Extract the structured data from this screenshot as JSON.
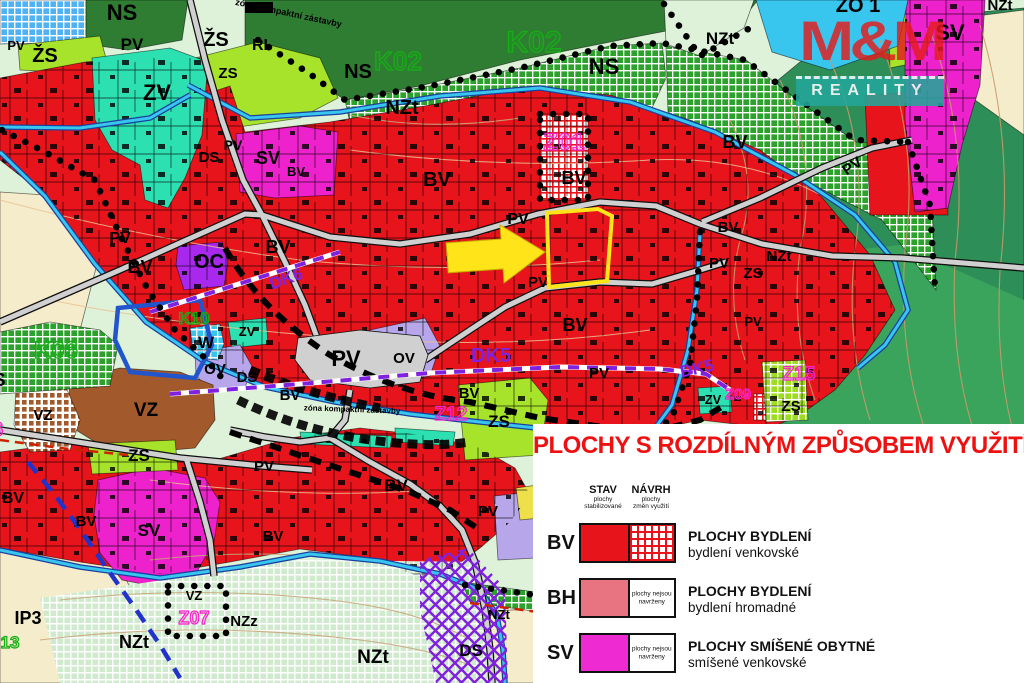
{
  "colors": {
    "bv_red": "#e8141b",
    "zv_teal": "#2de0b2",
    "zs_lime": "#a6e32a",
    "sv_magenta": "#ee22cc",
    "oc_purple": "#a928ee",
    "ov_lavender": "#b7a6ea",
    "vz_brown": "#a2592b",
    "nzt_pale": "#ddf2d8",
    "cream": "#f5eccb",
    "hill_green": "#2e8e57",
    "hill_green2": "#3aa45d",
    "ns_green": "#2f7d32",
    "k_grid_green": "#2ca12c",
    "water_cyan": "#38c6ef",
    "stream_blue": "#1b3f9e",
    "road_gray": "#d0d0d0",
    "blue_grid": "#4fb2f4",
    "pale_grid": "#cfeacc",
    "lime_grid": "#9ddc20",
    "route_purple": "#8021e0",
    "ip_blue": "#2233cc",
    "dash_red": "#cc2200",
    "highlight_yellow": "#ffe41a",
    "label_green": "#15b015",
    "label_magenta": "#f822cc",
    "legend_title_red": "#ee1111",
    "bh_pink": "#e87482",
    "sv_pink": "#ee2ad2",
    "logo_red": "#e41b1b",
    "logo_teal": "#23a79b"
  },
  "map": {
    "labels": [
      [
        "NS",
        122,
        20,
        22,
        "b"
      ],
      [
        "ŽS",
        45,
        62,
        20,
        "b"
      ],
      [
        "PV",
        16,
        50,
        13,
        "b"
      ],
      [
        "ZV",
        157,
        100,
        22,
        "b"
      ],
      [
        "ŽS",
        216,
        46,
        20,
        "b"
      ],
      [
        "ZS",
        228,
        78,
        15,
        "b"
      ],
      [
        "RI",
        260,
        50,
        16,
        "b"
      ],
      [
        "zóna kompaktní zástavby",
        288,
        16,
        9,
        "b",
        12
      ],
      [
        "PV",
        132,
        50,
        17,
        "b"
      ],
      [
        "NS",
        358,
        78,
        20,
        "b"
      ],
      [
        "K02",
        398,
        70,
        26,
        "g"
      ],
      [
        "K02",
        534,
        52,
        30,
        "g"
      ],
      [
        "NS",
        604,
        74,
        22,
        "b"
      ],
      [
        "NZt",
        402,
        114,
        20,
        "b"
      ],
      [
        "NZt",
        720,
        44,
        17,
        "b"
      ],
      [
        "ZO 1",
        858,
        12,
        20,
        "b"
      ],
      [
        "NZt",
        1000,
        10,
        15,
        "b"
      ],
      [
        "SV",
        950,
        40,
        22,
        "b"
      ],
      [
        "Z01",
        564,
        150,
        24,
        "m"
      ],
      [
        "BV",
        437,
        186,
        20,
        "b"
      ],
      [
        "BV",
        574,
        184,
        18,
        "b"
      ],
      [
        "BV",
        735,
        148,
        18,
        "b"
      ],
      [
        "PV",
        233,
        150,
        14,
        "b"
      ],
      [
        "DS",
        209,
        162,
        15,
        "b"
      ],
      [
        "SV",
        268,
        164,
        18,
        "b"
      ],
      [
        "BV",
        296,
        176,
        13,
        "b"
      ],
      [
        "PV",
        518,
        224,
        16,
        "b"
      ],
      [
        "PV",
        855,
        170,
        15,
        "b",
        -35
      ],
      [
        "BV",
        728,
        232,
        15,
        "b"
      ],
      [
        "PV",
        120,
        243,
        16,
        "b"
      ],
      [
        "BV",
        140,
        273,
        18,
        "b"
      ],
      [
        "BV",
        278,
        253,
        18,
        "b"
      ],
      [
        "OC",
        209,
        268,
        20,
        "b"
      ],
      [
        "DK6",
        288,
        284,
        17,
        "p",
        -20
      ],
      [
        "K10",
        194,
        324,
        17,
        "g"
      ],
      [
        "W",
        206,
        348,
        17,
        "b"
      ],
      [
        "ZV",
        247,
        336,
        13,
        "b"
      ],
      [
        "OV",
        215,
        374,
        15,
        "b"
      ],
      [
        "DS",
        247,
        382,
        15,
        "b"
      ],
      [
        "K06",
        56,
        358,
        24,
        "g"
      ],
      [
        "NS",
        -7,
        386,
        18,
        "b"
      ],
      [
        "Z06",
        -14,
        436,
        20,
        "m"
      ],
      [
        "VZ",
        43,
        420,
        15,
        "b"
      ],
      [
        "VZ",
        146,
        416,
        19,
        "b"
      ],
      [
        "PV",
        346,
        366,
        22,
        "b"
      ],
      [
        "OV",
        404,
        363,
        15,
        "b"
      ],
      [
        "zóna kompaktní zástavby",
        352,
        412,
        8,
        "b",
        2
      ],
      [
        "BV",
        290,
        400,
        15,
        "b"
      ],
      [
        "BV",
        469,
        398,
        15,
        "b"
      ],
      [
        "BV",
        575,
        331,
        18,
        "b"
      ],
      [
        "PV",
        538,
        287,
        15,
        "b"
      ],
      [
        "PV",
        719,
        268,
        15,
        "b"
      ],
      [
        "DK5",
        491,
        362,
        20,
        "p"
      ],
      [
        "DK5",
        698,
        374,
        17,
        "p",
        -12
      ],
      [
        "PV",
        599,
        378,
        15,
        "b"
      ],
      [
        "ZS",
        499,
        427,
        17,
        "b"
      ],
      [
        "Z12",
        451,
        420,
        19,
        "m"
      ],
      [
        "Z15",
        799,
        380,
        19,
        "m"
      ],
      [
        "Z09",
        738,
        399,
        15,
        "m"
      ],
      [
        "ZV",
        713,
        404,
        13,
        "b"
      ],
      [
        "ZS",
        791,
        411,
        15,
        "b"
      ],
      [
        "NZt",
        779,
        261,
        15,
        "b"
      ],
      [
        "ZS",
        753,
        278,
        15,
        "b"
      ],
      [
        "PV",
        753,
        326,
        13,
        "b"
      ],
      [
        "BV",
        13,
        503,
        16,
        "b"
      ],
      [
        "ZS",
        139,
        461,
        17,
        "b"
      ],
      [
        "PV",
        264,
        471,
        15,
        "b"
      ],
      [
        "BV",
        86,
        526,
        15,
        "b"
      ],
      [
        "SV",
        149,
        536,
        17,
        "b"
      ],
      [
        "BV",
        273,
        541,
        15,
        "b"
      ],
      [
        "BV",
        396,
        491,
        17,
        "b"
      ],
      [
        "PV",
        488,
        516,
        15,
        "b"
      ],
      [
        "NZt",
        134,
        648,
        18,
        "b"
      ],
      [
        "NZz",
        244,
        626,
        15,
        "b"
      ],
      [
        "Z07",
        194,
        624,
        18,
        "m"
      ],
      [
        "VZ",
        194,
        600,
        13,
        "b"
      ],
      [
        "IP3",
        28,
        624,
        18,
        "b"
      ],
      [
        "13",
        10,
        648,
        17,
        "g"
      ],
      [
        "NZt",
        373,
        663,
        19,
        "b"
      ],
      [
        "DS",
        471,
        656,
        17,
        "b"
      ],
      [
        "NZt",
        499,
        619,
        13,
        "b"
      ]
    ]
  },
  "logo": {
    "title": "M&M",
    "subtitle": "REALITY"
  },
  "legend": {
    "title": "PLOCHY S ROZDÍLNÝM ZPŮSOBEM VYUŽITÍ",
    "stav": {
      "header": "STAV",
      "sub1": "plochy",
      "sub2": "stabilizované"
    },
    "navrh": {
      "header": "NÁVRH",
      "sub1": "plochy",
      "sub2": "změn využití"
    },
    "note1": "plochy nejsou",
    "note2": "navrženy",
    "rows": [
      {
        "code": "BV",
        "name": "PLOCHY BYDLENÍ",
        "sub": "bydlení venkovské"
      },
      {
        "code": "BH",
        "name": "PLOCHY BYDLENÍ",
        "sub": "bydlení hromadné"
      },
      {
        "code": "SV",
        "name": "PLOCHY SMÍŠENÉ OBYTNÉ",
        "sub": "smíšené venkovské"
      }
    ]
  }
}
